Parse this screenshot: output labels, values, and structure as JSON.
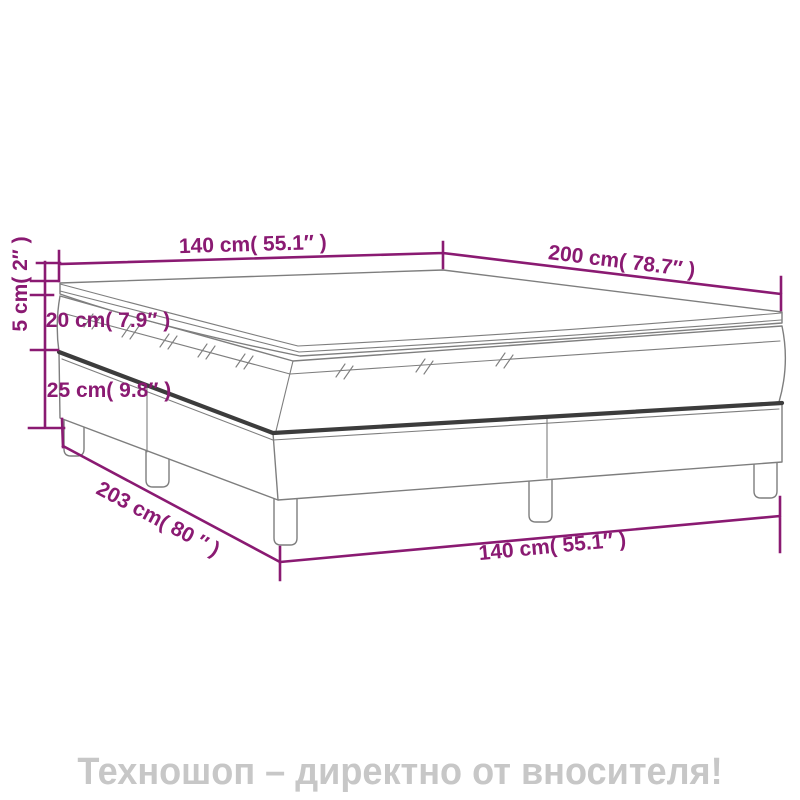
{
  "title": "Box spring bed dimension diagram",
  "dimensions": {
    "width_top": "140 cm( 55.1″ )",
    "length_top": "200 cm( 78.7″ )",
    "topper_height": "5 cm( 2″ )",
    "mattress_height": "20 cm( 7.9″ )",
    "base_height": "25 cm( 9.8″ )",
    "length_bottom": "203 cm( 80 ″ )",
    "width_bottom": "140 cm( 55.1″ )"
  },
  "banner": {
    "text": "Техношоп – директно от вносителя!"
  },
  "colors": {
    "dimension": "#8A1A72",
    "outline": "#7E7E7E",
    "seam": "#3C3C3C",
    "banner_text": "#C7C7C7",
    "background": "#FFFFFF"
  }
}
